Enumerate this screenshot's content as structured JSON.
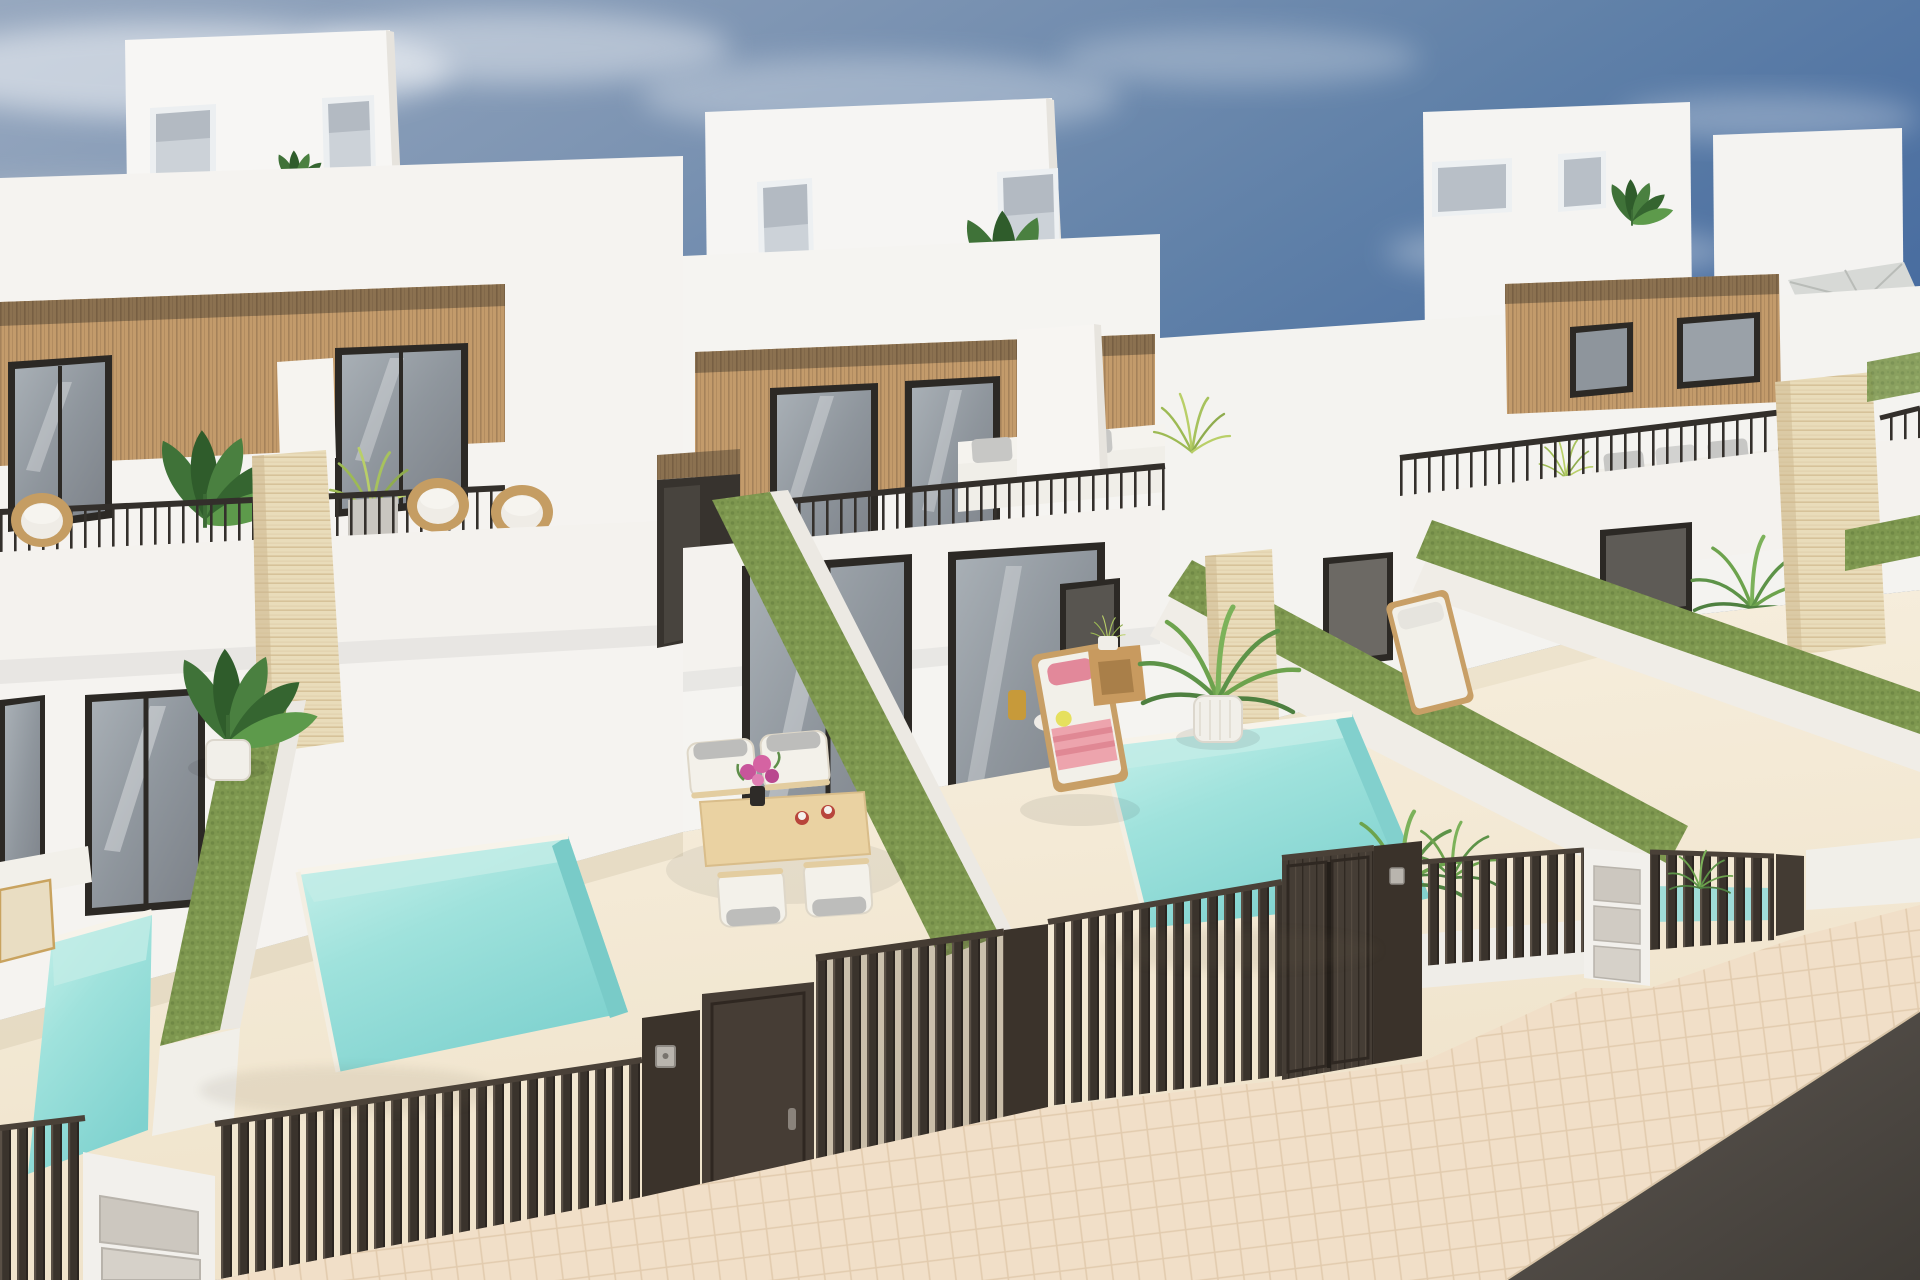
{
  "scene": {
    "description": "Photorealistic 3D exterior rendering, elevated view of a row of modern white two-storey villas with light wood slat cladding, rooftop terrace boxes, black-framed glass doors, balconies with thin black railings and rattan chairs, travertine divider pillars, green hedge party walls, private turquoise plunge pools, cream patios with outdoor furniture, a dark brown slatted street fence with gates and letterbox pillars, a herringbone paved sidewalk and asphalt road under a blue sky with soft clouds.",
    "style": "architectural CGI render",
    "sky": {
      "top_right": "#4d70a0",
      "top_left": "#93a5bd",
      "horizon": "#c3ccd7",
      "clouds": "soft white wisps"
    },
    "palette": {
      "wall_white": "#f5f3f0",
      "wall_shadow": "#e7e4de",
      "wood_cladding": "#c39b6b",
      "wood_dark_band": "#8b7150",
      "travertine": "#e9dcba",
      "hedge_green": "#7e974f",
      "pool_water": "#9fe2dc",
      "pool_water_light": "#cdf2ec",
      "fence_dark_brown": "#3b332b",
      "gate_brown": "#463d35",
      "patio_floor": "#f5ecd9",
      "sidewalk_paver": "#f1dfc8",
      "paver_joint": "#e2cbae",
      "road_asphalt": "#56504b",
      "window_frame": "#2c2925",
      "glass": "#9aa1a8",
      "rattan": "#c59d63",
      "cushion_white": "#f0eee8",
      "pillow_gray": "#bdbdbb",
      "towel_pink": "#eda4ad",
      "flower_magenta": "#c8559b",
      "lemon_yellow": "#e6e05e"
    },
    "villas": [
      {
        "name": "villa-left",
        "features": [
          "roof box with two blind windows",
          "wood clad upper floor",
          "two black glass sliders",
          "balcony with two rattan chairs and banana plant",
          "ground floor glass doors",
          "dining patio",
          "plunge pool"
        ]
      },
      {
        "name": "villa-middle",
        "features": [
          "roof box with plant",
          "terrace with white sofa and railing",
          "wood cladding",
          "entry corridor",
          "sun lounger with pink towel",
          "plunge pool",
          "potted palm"
        ]
      },
      {
        "name": "villa-right",
        "features": [
          "two roof boxes",
          "cantilever parasol",
          "terrace sofa with gray pillows",
          "wood clad band with windows",
          "green hedge walls",
          "sun lounger"
        ]
      }
    ],
    "objects": [
      "pool-left",
      "pool-center",
      "pool-right",
      "hedge-wall-a",
      "hedge-wall-b",
      "hedge-wall-c",
      "hedge-wall-d",
      "travertine-pillar-a",
      "travertine-pillar-c",
      "travertine-pillar-right",
      "street-fence",
      "pedestrian-door",
      "sliding-gate",
      "double-gate",
      "letterbox-pillar-left",
      "letterbox-pillar-right",
      "dining-set",
      "sun-lounger-pink",
      "sun-lounger-white",
      "sidewalk-herringbone",
      "asphalt-road",
      "clouds"
    ]
  }
}
